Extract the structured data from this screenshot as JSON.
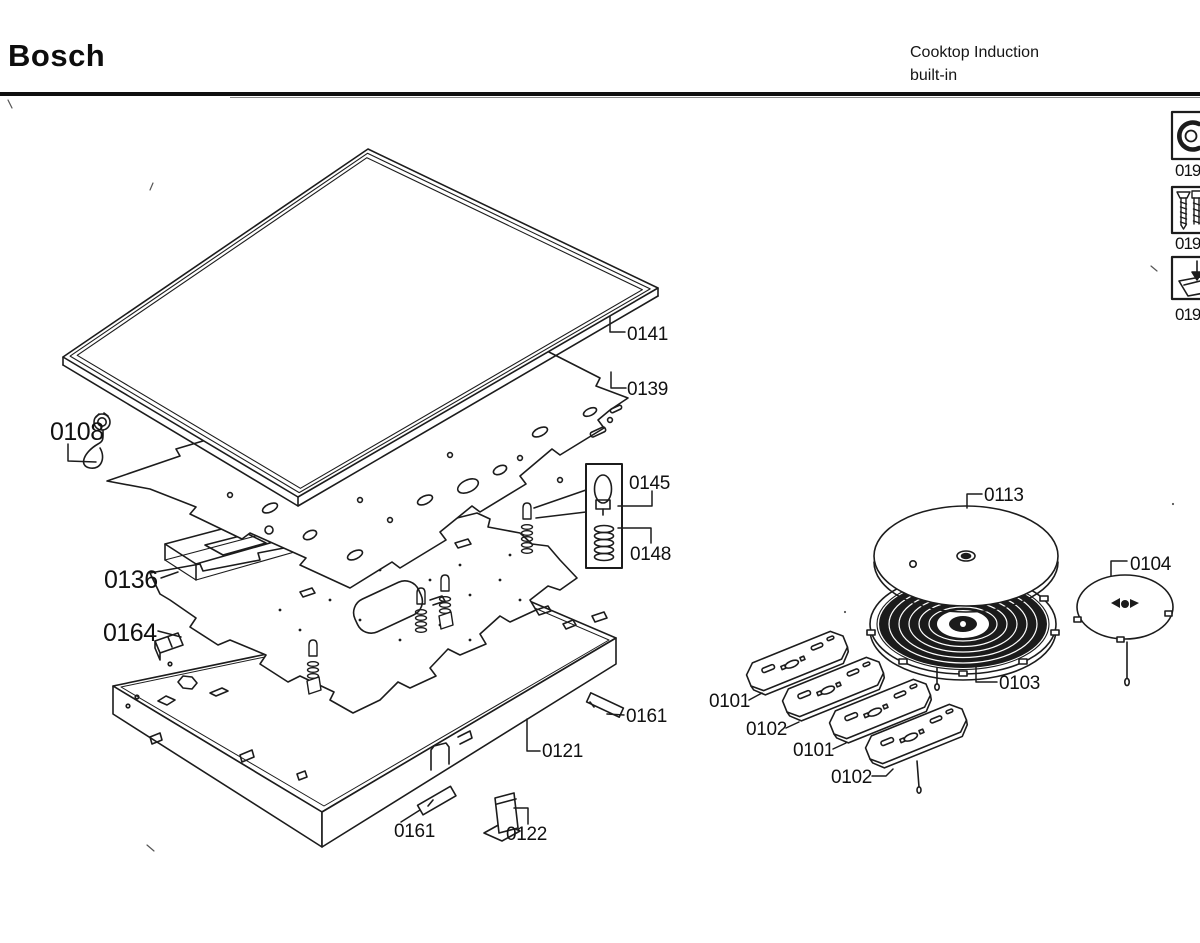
{
  "header": {
    "brand": "Bosch",
    "product_line_1": "Cooktop Induction",
    "product_line_2": "built-in"
  },
  "side_icons": [
    {
      "icon": "clamp-tool-icon",
      "label": "019"
    },
    {
      "icon": "screws-icon",
      "label": "019"
    },
    {
      "icon": "bracket-funnel-icon",
      "label": "019"
    }
  ],
  "diagram": {
    "labels": [
      {
        "part": "glass-ceramic-top",
        "text": "0141"
      },
      {
        "part": "cover-sheet",
        "text": "0139"
      },
      {
        "part": "grommet-with-wire",
        "text": "0108"
      },
      {
        "part": "lamp",
        "text": "0145"
      },
      {
        "part": "spring",
        "text": "0148"
      },
      {
        "part": "support-frame",
        "text": "0136"
      },
      {
        "part": "clip-bracket",
        "text": "0164"
      },
      {
        "part": "fixing-rail-right",
        "text": "0161"
      },
      {
        "part": "base-tray",
        "text": "0121"
      },
      {
        "part": "fixing-rail-front",
        "text": "0161"
      },
      {
        "part": "mounting-bracket",
        "text": "0122"
      },
      {
        "part": "shield-disc-large",
        "text": "0113"
      },
      {
        "part": "shield-disc-small",
        "text": "0104"
      },
      {
        "part": "induction-coil",
        "text": "0103"
      },
      {
        "part": "ferrite-plate-1",
        "text": "0101"
      },
      {
        "part": "ferrite-plate-2",
        "text": "0102"
      },
      {
        "part": "ferrite-plate-3",
        "text": "0101"
      },
      {
        "part": "ferrite-plate-4",
        "text": "0102"
      }
    ]
  }
}
